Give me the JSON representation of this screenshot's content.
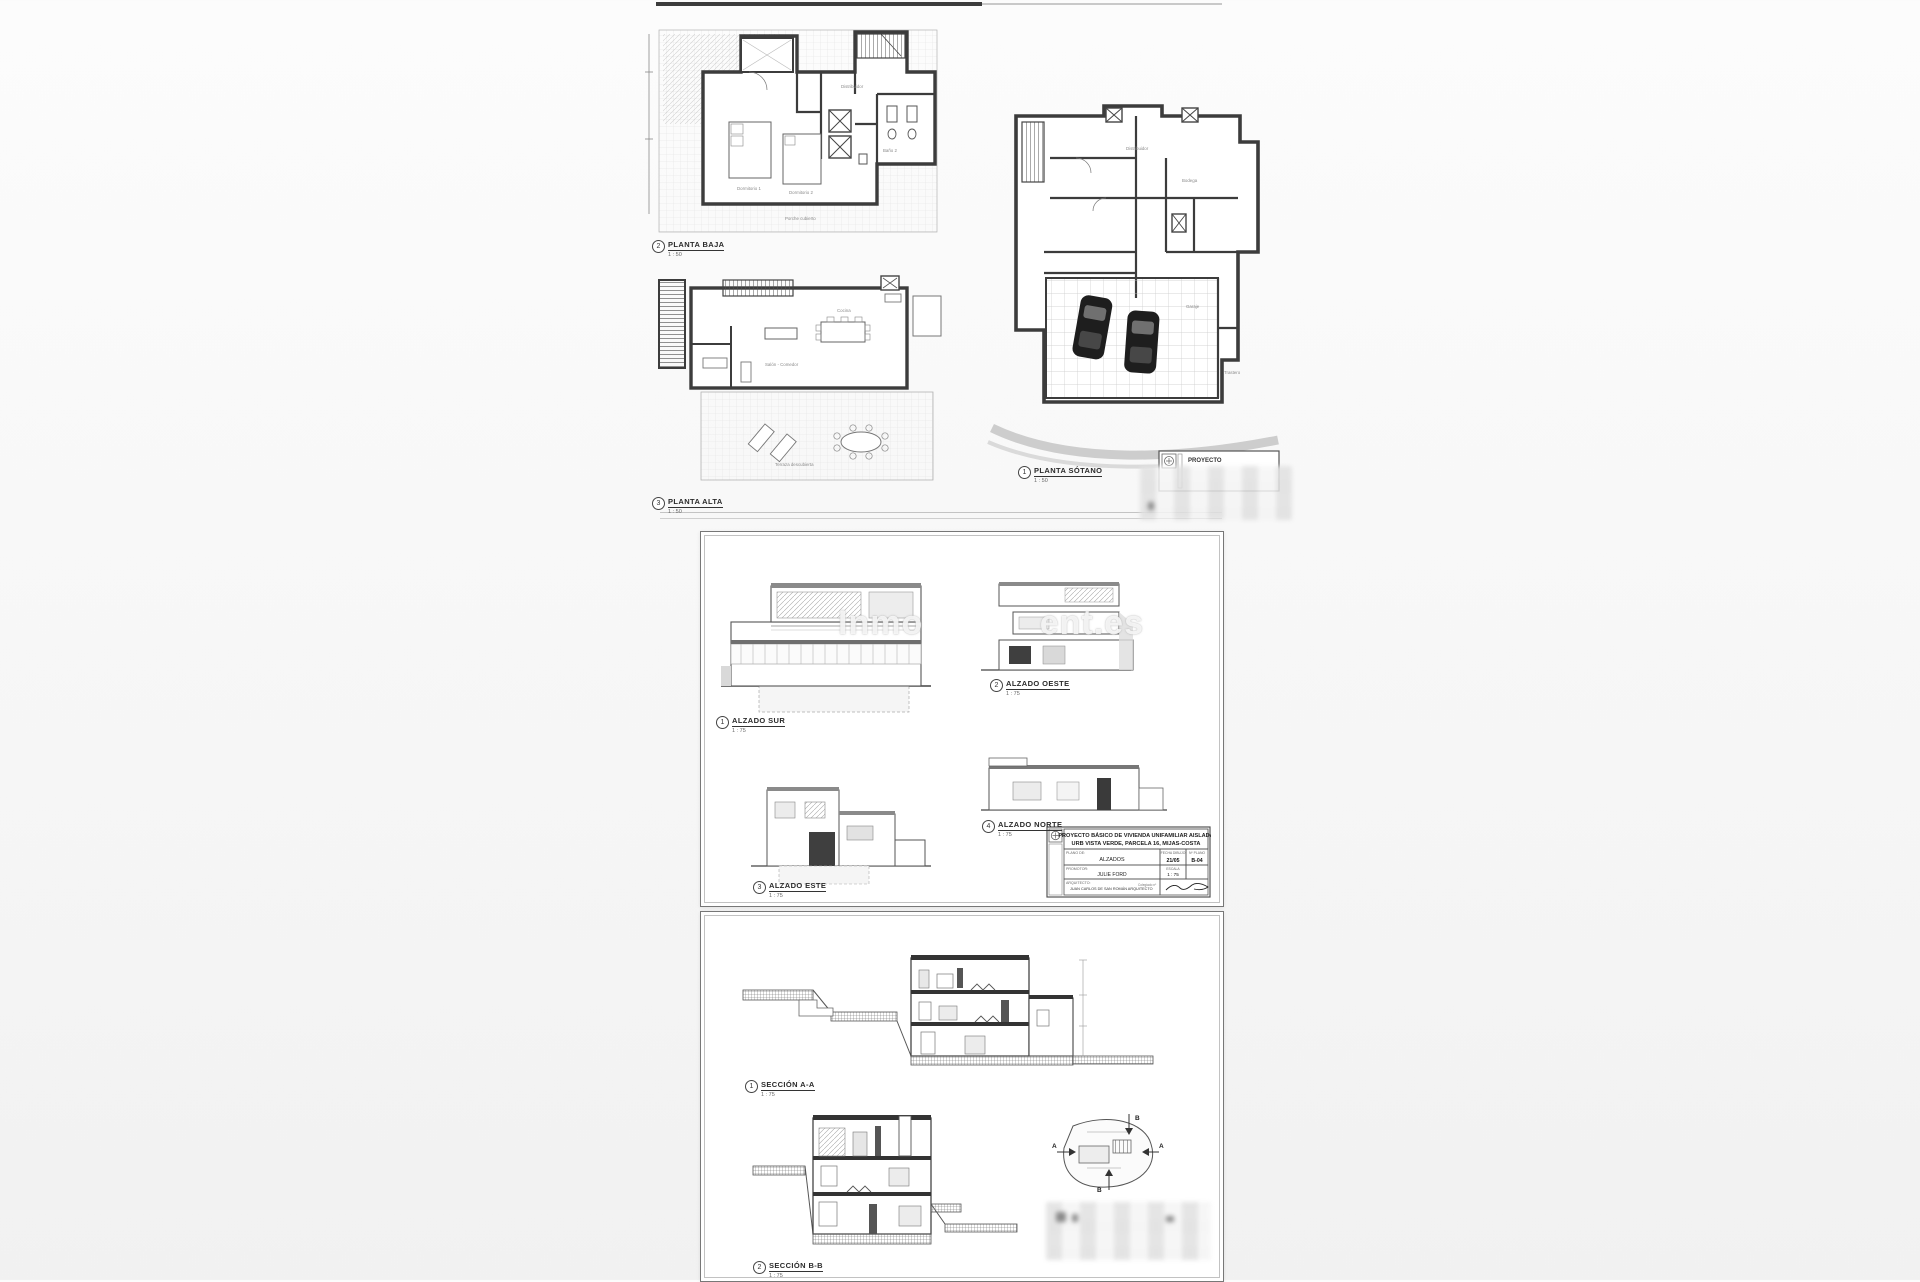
{
  "watermark": {
    "left": "Inmo",
    "right": "ent.es"
  },
  "figures": [
    {
      "num": "2",
      "label": "PLANTA BAJA",
      "scale": "1 : 50"
    },
    {
      "num": "3",
      "label": "PLANTA ALTA",
      "scale": "1 : 50"
    },
    {
      "num": "1",
      "label": "PLANTA SÓTANO",
      "scale": "1 : 50"
    },
    {
      "num": "1",
      "label": "ALZADO SUR",
      "scale": "1 : 75"
    },
    {
      "num": "2",
      "label": "ALZADO OESTE",
      "scale": "1 : 75"
    },
    {
      "num": "4",
      "label": "ALZADO NORTE",
      "scale": "1 : 75"
    },
    {
      "num": "3",
      "label": "ALZADO ESTE",
      "scale": "1 : 75"
    },
    {
      "num": "1",
      "label": "SECCIÓN A-A",
      "scale": "1 : 75"
    },
    {
      "num": "2",
      "label": "SECCIÓN B-B",
      "scale": "1 : 75"
    }
  ],
  "rooms": {
    "planta_baja": {
      "r1": "Distribuidor",
      "r2": "Dormitorio 1",
      "r3": "Dormitorio 2",
      "r4": "Baño 2",
      "r5": "Porche cubierto"
    },
    "planta_alta": {
      "r1": "Salón - Comedor",
      "r2": "Cocina",
      "r3": "Terraza descubierta"
    },
    "planta_sotano": {
      "r1": "Distribuidor",
      "r2": "Garaje",
      "r3": "Bodega",
      "r4": "Trastero"
    }
  },
  "titleblock": {
    "title_line1": "PROYECTO BÁSICO DE VIVIENDA UNIFAMILIAR AISLADA",
    "title_line2": "URB VISTA VERDE, PARCELA 16, MIJAS-COSTA",
    "plano_label": "PLANO DE:",
    "plano_value": "ALZADOS",
    "fecha_label": "FECHA DIBUJO",
    "fecha_value": "21/05",
    "num_label": "Nº PLANO",
    "num_value": "B-04",
    "promotor_label": "PROMOTOR:",
    "promotor_value": "JULIE FORD",
    "escala_label": "ESCALA",
    "escala_value": "1 : 75",
    "arquitecto_label": "ARQUITECTO:",
    "arquitecto_value": "JUAN CARLOS DE SAN ROMÁN ARQUITECTO",
    "colegiado_label": "Colegiado nº"
  },
  "partial_titleblock": {
    "text": "PROYECTO"
  },
  "site_key": {
    "a": "A",
    "b": "B"
  }
}
